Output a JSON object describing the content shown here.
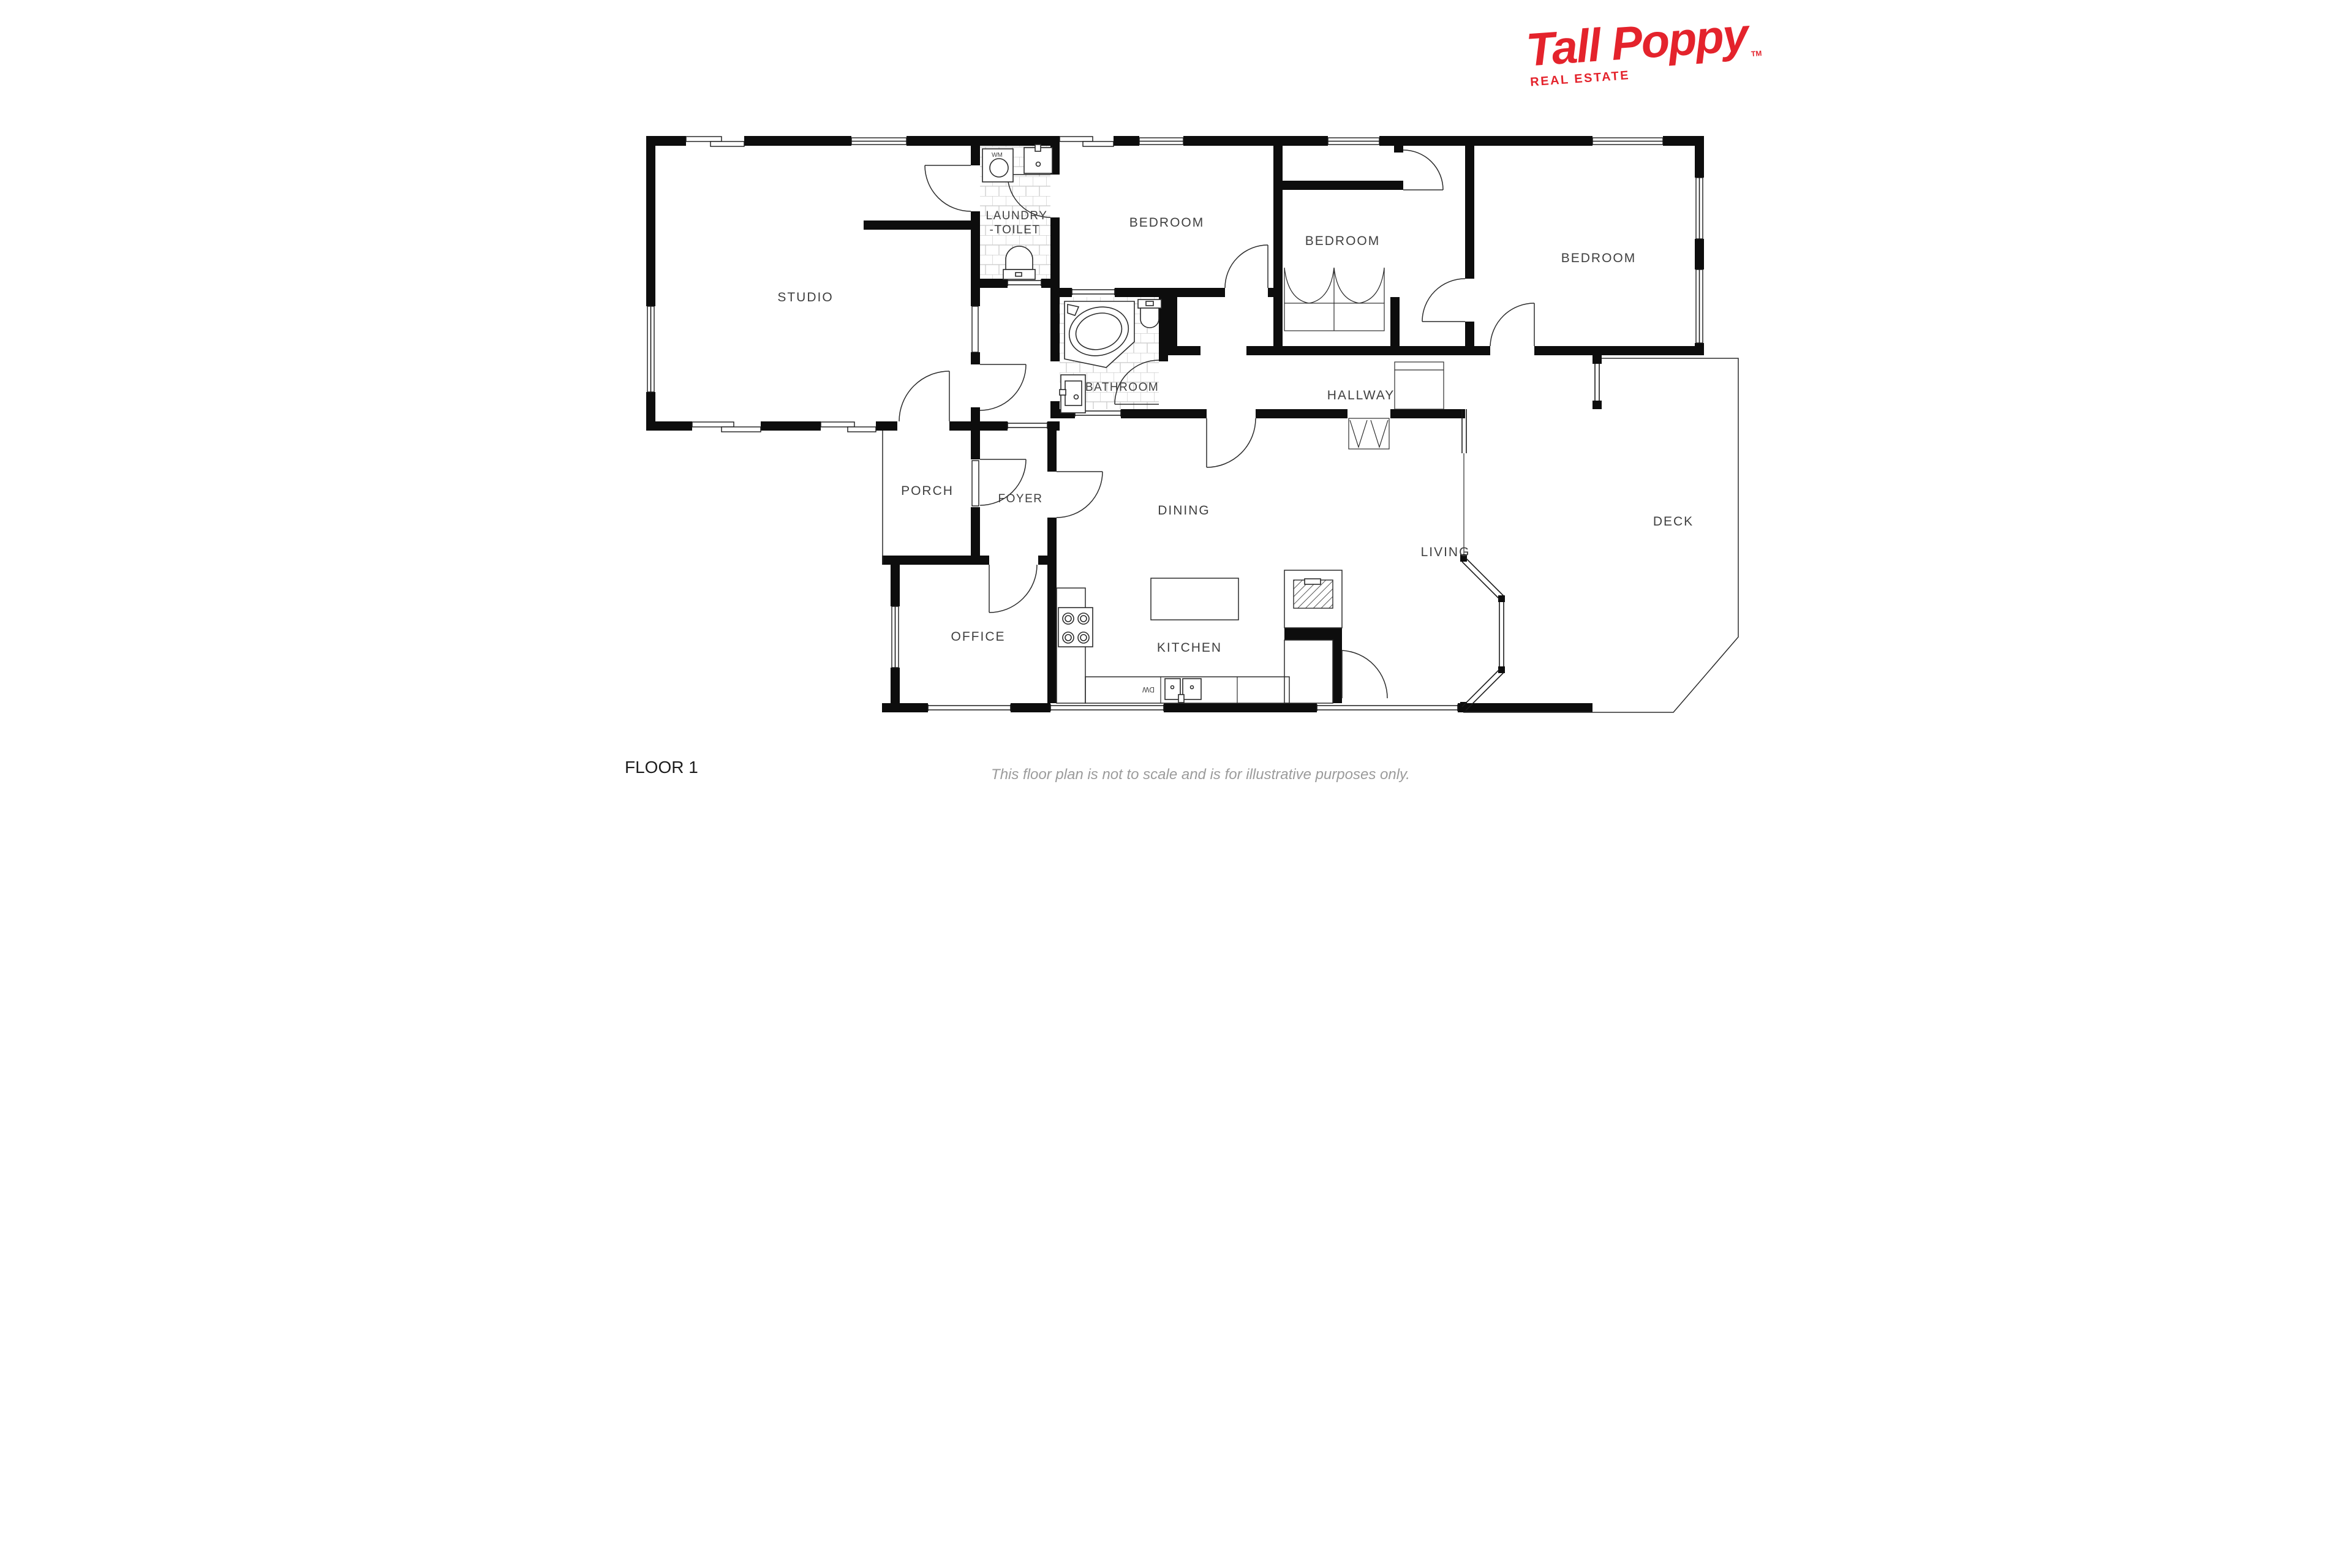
{
  "header": {
    "brand": "Tall Poppy",
    "tagline": "REAL ESTATE",
    "trademark": "TM",
    "brand_color": "#e4232c"
  },
  "rooms": {
    "studio": "STUDIO",
    "laundry_line1": "LAUNDRY",
    "laundry_line2": "-TOILET",
    "bedroom_front": "BEDROOM",
    "bedroom_middle": "BEDROOM",
    "bedroom_rear": "BEDROOM",
    "bathroom": "BATHROOM",
    "hallway": "HALLWAY",
    "porch": "PORCH",
    "foyer": "FOYER",
    "dining": "DINING",
    "office": "OFFICE",
    "kitchen": "KITCHEN",
    "living": "LIVING",
    "deck": "DECK"
  },
  "fixtures": {
    "washing_machine": "WM",
    "dishwasher": "DW"
  },
  "footer": {
    "floor_label": "FLOOR 1",
    "disclaimer": "This floor plan is not to scale and is for illustrative purposes only."
  },
  "colors": {
    "wall": "#0d0d0d",
    "line": "#2b2b2b",
    "tile_line": "#c9c9c9",
    "label": "#3f3f3f",
    "disclaimer": "#9b9b9b",
    "logo_red": "#e4232c"
  }
}
